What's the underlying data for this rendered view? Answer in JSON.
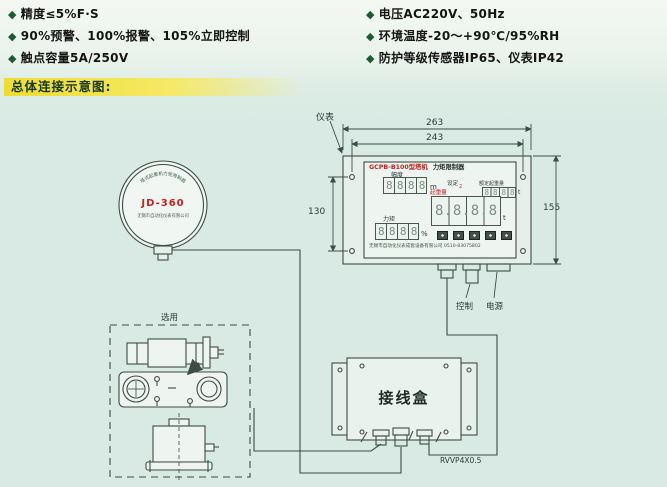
{
  "bullet_glyph": "◆",
  "specs": {
    "left": [
      "精度≤5%F·S",
      "90%预警、100%报警、105%立即控制",
      "触点容量5A/250V"
    ],
    "right": [
      "电压AC220V、50Hz",
      "环境温度-20～+90℃/95%RH",
      "防护等级传感器IP65、仪表IP42"
    ]
  },
  "section_heading": "总体连接示意图:",
  "colors": {
    "page_background": "#d9e9e3",
    "heading_bar": "#eedd2e",
    "heading_text": "#17391d",
    "bullet_diamond": "#1d5c2f",
    "line_color": "#3d4c46",
    "accent_red": "#c32222"
  },
  "diagram": {
    "labels": {
      "instrument": "仪表",
      "control": "控制",
      "power": "电源",
      "optional": "选用",
      "junction_box": "接线盒",
      "cable": "RVVP4X0.5"
    },
    "dimensions": {
      "outer_width": "263",
      "mount_span": "243",
      "mount_height": "130",
      "outer_height": "155"
    },
    "gauge": {
      "model": "JD-360",
      "arc_text": "塔式起重机力矩限制器",
      "sub_text": "无锡市自动化仪表有限公司"
    },
    "panel": {
      "title_red": "GCPB-B100型塔机",
      "title_black": "力矩限制器",
      "amplitude": {
        "label": "幅度",
        "value": "8888",
        "unit": "m"
      },
      "setting": {
        "label": "设定",
        "indicator": "2",
        "label_red": "起重量"
      },
      "rated": {
        "label": "额定起重量",
        "value": "8888",
        "unit": "t"
      },
      "weight": {
        "value": "8.8.8.8",
        "unit": "t"
      },
      "moment": {
        "label": "力矩",
        "value": "8888",
        "unit": "%"
      },
      "footer": "无锡市自动化仪表成套设备有限公司 0510-83075802"
    }
  }
}
